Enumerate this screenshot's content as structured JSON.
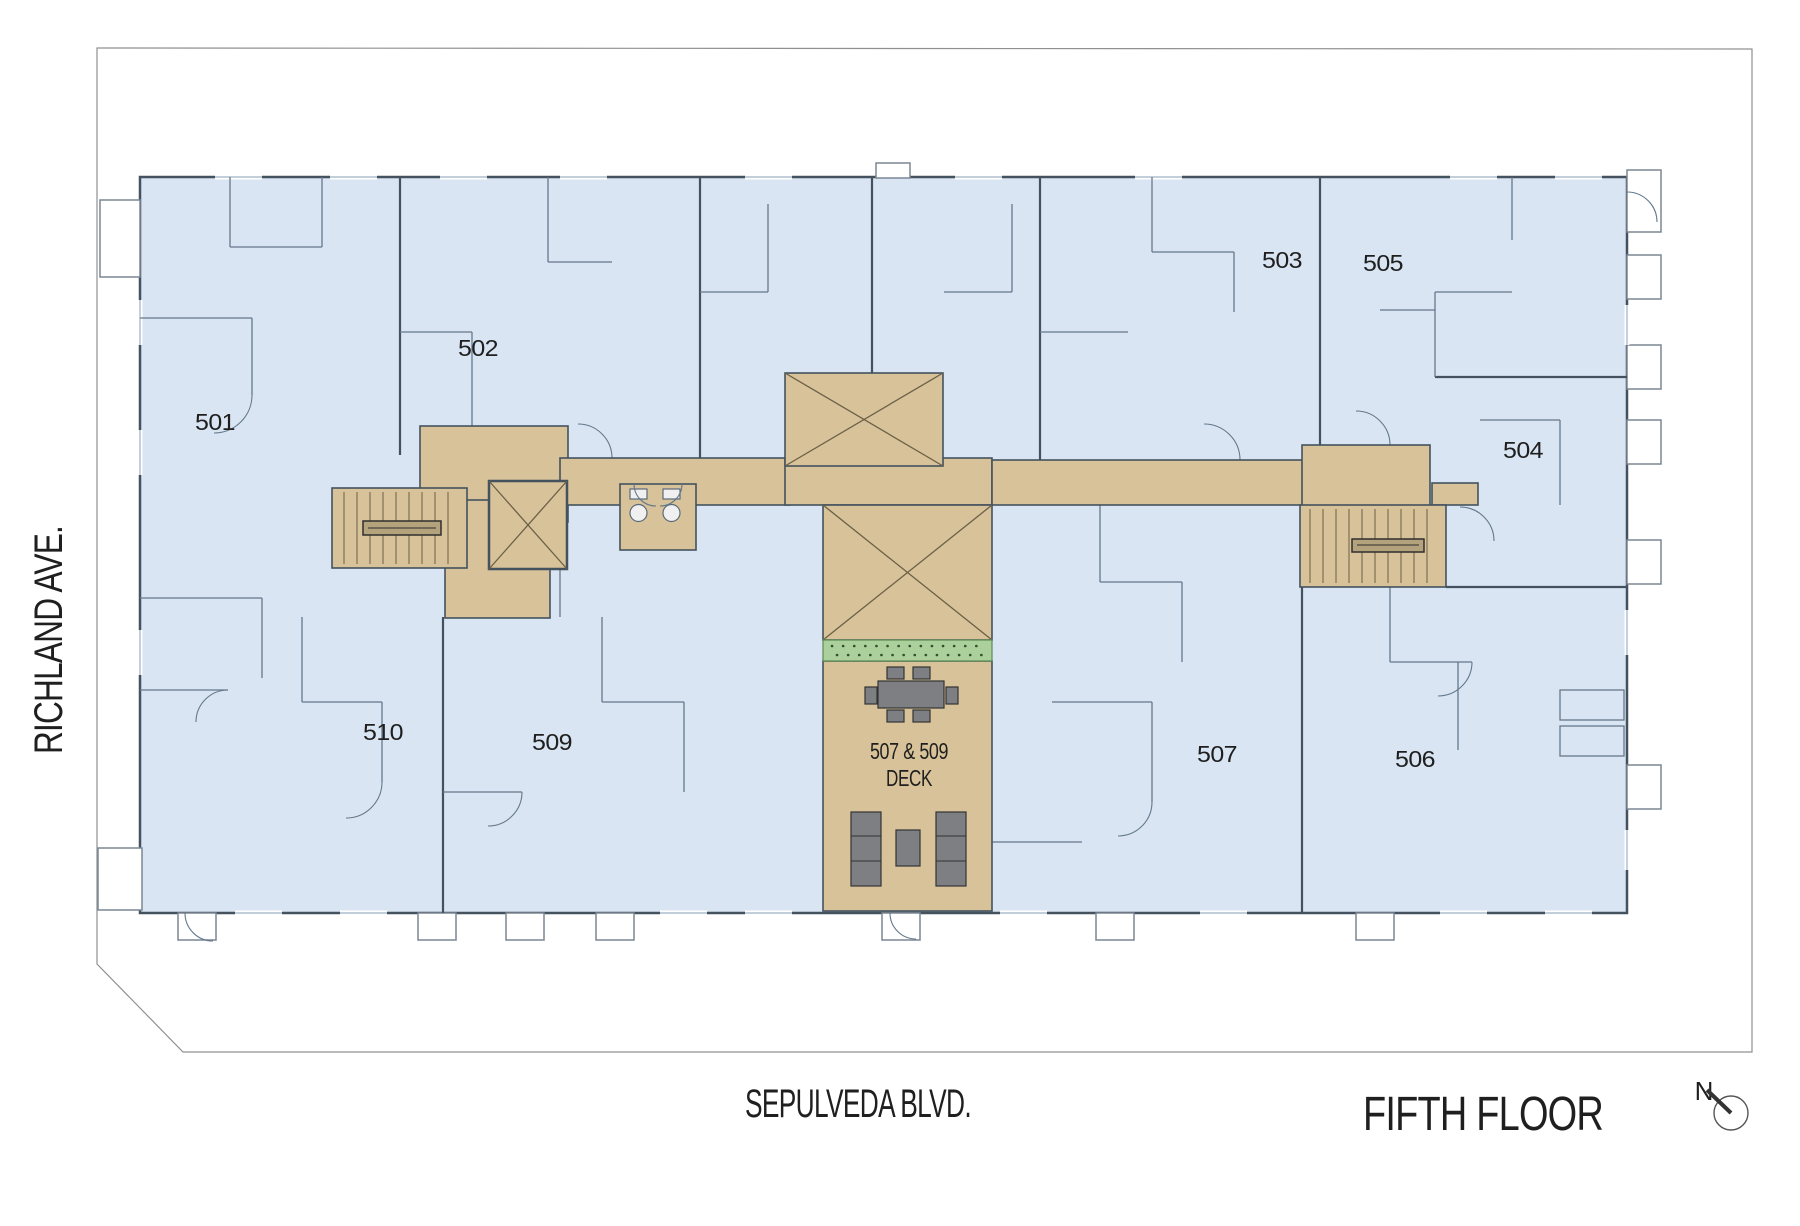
{
  "plan": {
    "title": "FIFTH FLOOR",
    "north_label": "N",
    "streets": {
      "left": "RICHLAND AVE.",
      "bottom": "SEPULVEDA BLVD."
    },
    "deck": {
      "line1": "507 & 509",
      "line2": "DECK"
    },
    "units": [
      {
        "number": "501"
      },
      {
        "number": "502"
      },
      {
        "number": "503"
      },
      {
        "number": "504"
      },
      {
        "number": "505"
      },
      {
        "number": "506"
      },
      {
        "number": "507"
      },
      {
        "number": "509"
      },
      {
        "number": "510"
      }
    ],
    "colors": {
      "unit_fill": "#d9e5f2",
      "corridor_fill": "#d7c299",
      "planter_fill": "#abd09c",
      "wall": "#44525f",
      "furniture": "#7d7f82",
      "property_line": "#909090",
      "text": "#1f1f1f"
    }
  }
}
